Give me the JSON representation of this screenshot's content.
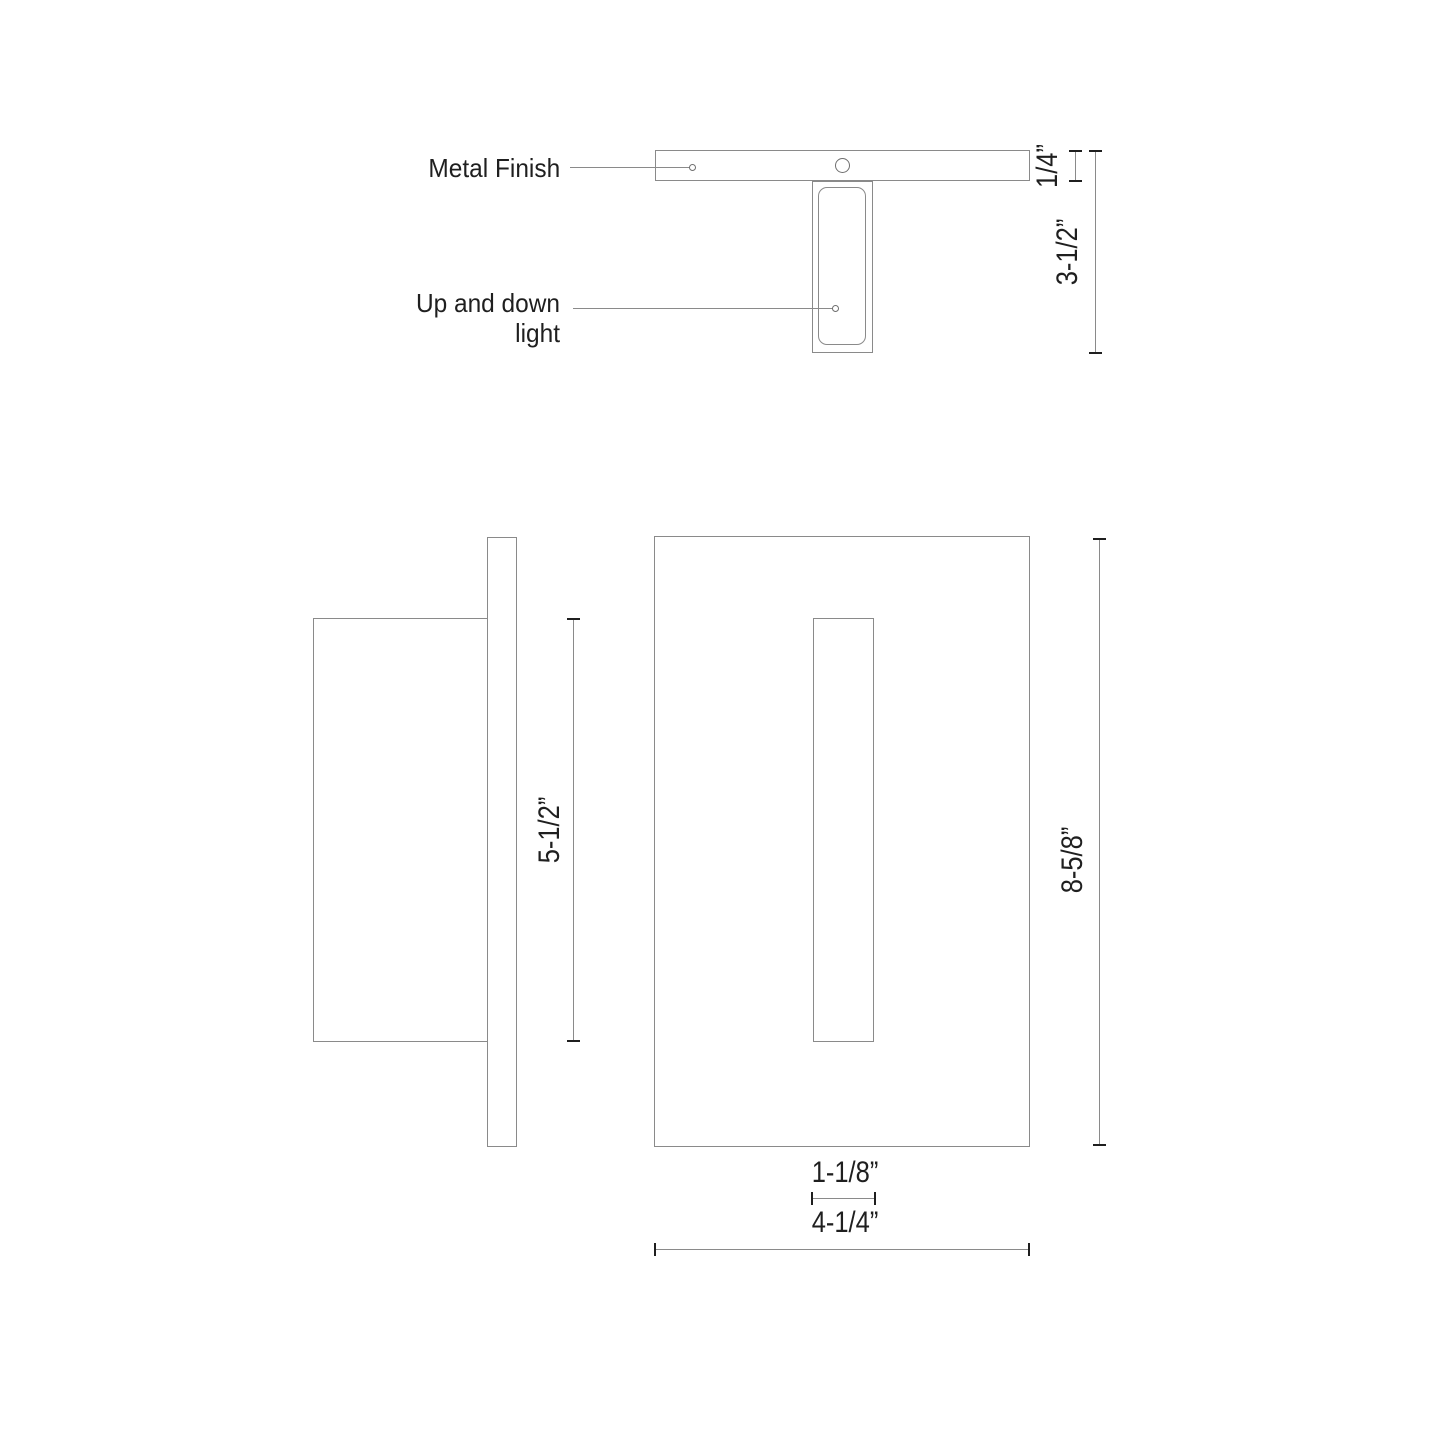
{
  "page": {
    "background": "#ffffff"
  },
  "drawing": {
    "colors": {
      "line": "#8a8a8a",
      "tick": "#1f1f1f",
      "text": "#1f1f1f"
    },
    "top_view": {
      "labels": {
        "metal_finish": "Metal Finish",
        "up_and_down_light": "Up and down light"
      },
      "dimensions": {
        "plate_thickness": "1/4”",
        "overall_depth": "3-1/2”"
      }
    },
    "side_view": {
      "dimensions": {
        "body_height": "5-1/2”"
      }
    },
    "front_view": {
      "dimensions": {
        "overall_height": "8-5/8”",
        "slot_width": "1-1/8”",
        "overall_width": "4-1/4”"
      }
    }
  }
}
